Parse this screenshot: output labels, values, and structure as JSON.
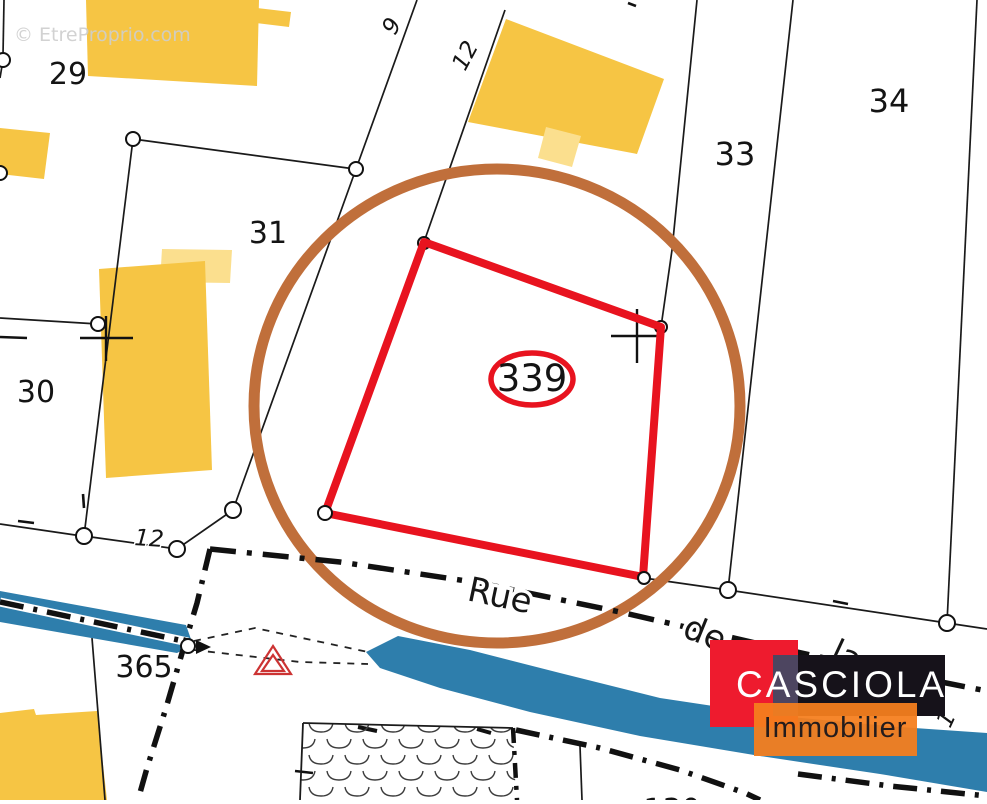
{
  "watermark": {
    "text": "© EtreProprio.com"
  },
  "map": {
    "parcels": [
      "29",
      "31",
      "30",
      "33",
      "34",
      "365"
    ],
    "highlighted_parcel": "339",
    "street_parts": [
      "Rue",
      "de",
      "la"
    ],
    "measures": {
      "nine": "9",
      "twelve_top": "12",
      "twelve_bottom": "12",
      "one": "1",
      "partial_bottom": "130"
    }
  },
  "logo": {
    "brand": "CASCIOLA",
    "tagline": "Immobilier"
  },
  "colors": {
    "building": "#F6C544",
    "building_light": "#FBDF8E",
    "waterway": "#2E7EAC",
    "highlight_circle": "#C06F3B",
    "parcel_outline_red": "#E8131F",
    "boundary_line": "#1A1A1A",
    "logo_red": "#EE1B2E",
    "logo_black": "#16121A",
    "logo_orange": "#F57E1E",
    "triangle_symbol_red": "#CC3333"
  }
}
